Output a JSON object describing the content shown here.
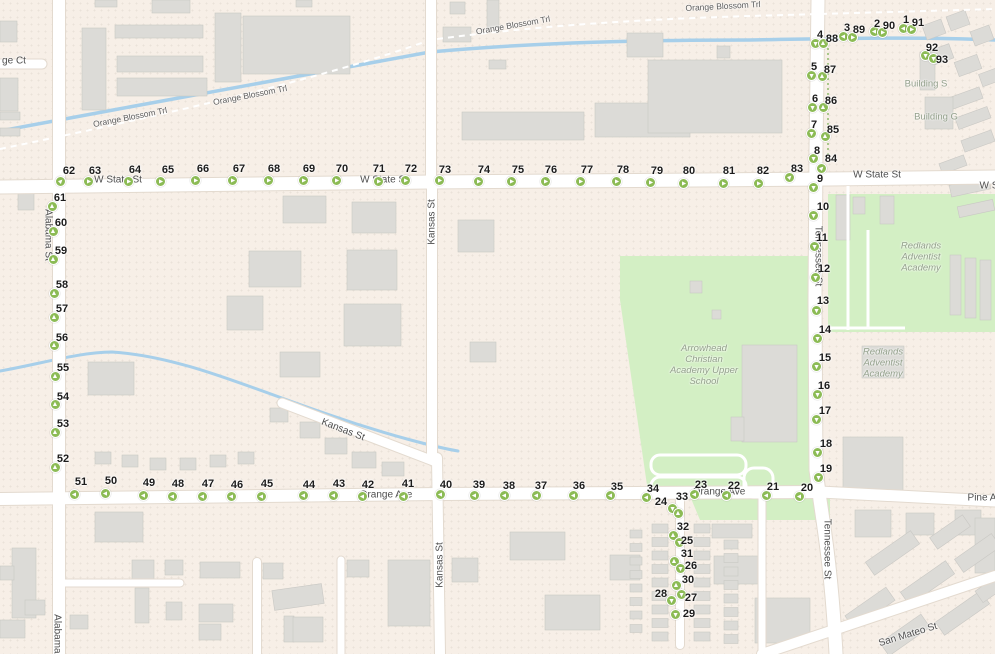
{
  "app": {
    "title": "Map with numbered survey route markers"
  },
  "colors": {
    "land": "#f7efe7",
    "road": "#ffffff",
    "road_casing": "#e3dacf",
    "green_area": "#d3efc4",
    "building": "#dcdbd7",
    "building_edge": "#c9c8c4",
    "water": "#a7cfea",
    "marker_green": "#8cbb55",
    "hedge_green": "#a8c88a"
  },
  "street_labels": [
    {
      "text": "Orange Blossom Trl",
      "x": 130,
      "y": 117,
      "rot": -11,
      "kind": "trail"
    },
    {
      "text": "Orange Blossom Trl",
      "x": 250,
      "y": 95,
      "rot": -11,
      "kind": "trail"
    },
    {
      "text": "Orange Blossom Trl",
      "x": 513,
      "y": 25,
      "rot": -10,
      "kind": "trail"
    },
    {
      "text": "Orange Blossom Trl",
      "x": 723,
      "y": 6,
      "rot": -3,
      "kind": "trail"
    },
    {
      "text": "ge Ct",
      "x": 14,
      "y": 61,
      "rot": 0
    },
    {
      "text": "W State St",
      "x": 118,
      "y": 180,
      "rot": 0
    },
    {
      "text": "W State St",
      "x": 384,
      "y": 180,
      "rot": 0
    },
    {
      "text": "W State St",
      "x": 877,
      "y": 175,
      "rot": 0
    },
    {
      "text": "W S",
      "x": 989,
      "y": 186,
      "rot": 0
    },
    {
      "text": "Orange Ave",
      "x": 386,
      "y": 495,
      "rot": 0
    },
    {
      "text": "Orange Ave",
      "x": 719,
      "y": 492,
      "rot": 0
    },
    {
      "text": "Pine A",
      "x": 982,
      "y": 498,
      "rot": 0
    },
    {
      "text": "Alabama St",
      "x": 48,
      "y": 235,
      "rot": 90
    },
    {
      "text": "Alabama St",
      "x": 57,
      "y": 640,
      "rot": 90
    },
    {
      "text": "Kansas St",
      "x": 432,
      "y": 222,
      "rot": -90
    },
    {
      "text": "Kansas St",
      "x": 440,
      "y": 565,
      "rot": -90
    },
    {
      "text": "Kansas St",
      "x": 343,
      "y": 430,
      "rot": 21
    },
    {
      "text": "Tennessee St",
      "x": 818,
      "y": 256,
      "rot": 90
    },
    {
      "text": "Tennessee St",
      "x": 827,
      "y": 549,
      "rot": 90
    },
    {
      "text": "San Mateo St",
      "x": 908,
      "y": 635,
      "rot": -17
    }
  ],
  "area_labels": [
    {
      "text": "Building S",
      "x": 926,
      "y": 85,
      "italic": false
    },
    {
      "text": "Building G",
      "x": 936,
      "y": 118,
      "italic": false
    },
    {
      "text": "Redlands\nAdventist\nAcademy",
      "x": 921,
      "y": 258,
      "italic": true
    },
    {
      "text": "Redlands\nAdventist\nAcademy",
      "x": 883,
      "y": 364,
      "italic": true
    },
    {
      "text": "Arrowhead\nChristian\nAcademy Upper\nSchool",
      "x": 704,
      "y": 366,
      "italic": true
    }
  ],
  "markers_format": "[number, circle_x, circle_y, arrow_dir(u/d/l/r/ne), label_x, label_y]",
  "markers": [
    [
      1,
      903,
      28,
      "l",
      906,
      20
    ],
    [
      91,
      911,
      29,
      "r",
      918,
      23
    ],
    [
      2,
      874,
      31,
      "l",
      877,
      24
    ],
    [
      90,
      882,
      32,
      "r",
      889,
      26
    ],
    [
      3,
      843,
      36,
      "l",
      847,
      28
    ],
    [
      89,
      852,
      37,
      "r",
      859,
      30
    ],
    [
      4,
      815,
      43,
      "d",
      820,
      35
    ],
    [
      88,
      823,
      43,
      "u",
      832,
      39
    ],
    [
      92,
      925,
      55,
      "d",
      932,
      48
    ],
    [
      93,
      933,
      58,
      "d",
      942,
      60
    ],
    [
      5,
      811,
      75,
      "d",
      814,
      67
    ],
    [
      87,
      822,
      76,
      "u",
      830,
      70
    ],
    [
      6,
      812,
      107,
      "d",
      815,
      99
    ],
    [
      86,
      823,
      107,
      "u",
      831,
      101
    ],
    [
      7,
      811,
      133,
      "d",
      814,
      125
    ],
    [
      85,
      825,
      136,
      "u",
      833,
      130
    ],
    [
      8,
      813,
      158,
      "d",
      817,
      151
    ],
    [
      84,
      821,
      168,
      "ne",
      831,
      159
    ],
    [
      9,
      813,
      187,
      "d",
      820,
      179
    ],
    [
      10,
      813,
      215,
      "d",
      823,
      207
    ],
    [
      11,
      814,
      246,
      "d",
      822,
      238
    ],
    [
      12,
      815,
      277,
      "d",
      824,
      269
    ],
    [
      13,
      816,
      310,
      "d",
      823,
      301
    ],
    [
      14,
      817,
      338,
      "d",
      825,
      330
    ],
    [
      15,
      816,
      366,
      "d",
      825,
      358
    ],
    [
      16,
      817,
      394,
      "d",
      824,
      386
    ],
    [
      17,
      816,
      419,
      "d",
      825,
      411
    ],
    [
      18,
      817,
      452,
      "d",
      826,
      444
    ],
    [
      19,
      818,
      477,
      "d",
      826,
      469
    ],
    [
      20,
      799,
      496,
      "l",
      807,
      488
    ],
    [
      21,
      766,
      495,
      "l",
      773,
      487
    ],
    [
      22,
      726,
      495,
      "l",
      734,
      486
    ],
    [
      23,
      694,
      494,
      "l",
      701,
      485
    ],
    [
      24,
      672,
      508,
      "d",
      661,
      502
    ],
    [
      33,
      678,
      513,
      "u",
      682,
      497
    ],
    [
      32,
      673,
      535,
      "u",
      683,
      527
    ],
    [
      25,
      679,
      542,
      "d",
      687,
      541
    ],
    [
      31,
      674,
      561,
      "u",
      687,
      554
    ],
    [
      26,
      680,
      568,
      "d",
      691,
      566
    ],
    [
      30,
      676,
      585,
      "u",
      688,
      580
    ],
    [
      27,
      681,
      594,
      "d",
      691,
      598
    ],
    [
      28,
      671,
      600,
      "d",
      661,
      594
    ],
    [
      29,
      675,
      614,
      "d",
      689,
      614
    ],
    [
      34,
      646,
      497,
      "l",
      653,
      489
    ],
    [
      35,
      610,
      495,
      "l",
      617,
      487
    ],
    [
      36,
      573,
      495,
      "l",
      579,
      486
    ],
    [
      37,
      536,
      495,
      "l",
      541,
      486
    ],
    [
      38,
      504,
      495,
      "l",
      509,
      486
    ],
    [
      39,
      474,
      495,
      "l",
      479,
      485
    ],
    [
      40,
      440,
      494,
      "l",
      446,
      485
    ],
    [
      41,
      403,
      496,
      "l",
      408,
      484
    ],
    [
      42,
      362,
      496,
      "l",
      368,
      485
    ],
    [
      43,
      333,
      495,
      "l",
      339,
      484
    ],
    [
      44,
      303,
      495,
      "l",
      309,
      485
    ],
    [
      45,
      261,
      496,
      "l",
      267,
      484
    ],
    [
      46,
      231,
      496,
      "l",
      237,
      485
    ],
    [
      47,
      202,
      496,
      "l",
      208,
      484
    ],
    [
      48,
      172,
      496,
      "l",
      178,
      484
    ],
    [
      49,
      143,
      495,
      "l",
      149,
      483
    ],
    [
      50,
      105,
      493,
      "l",
      111,
      481
    ],
    [
      51,
      74,
      494,
      "l",
      81,
      482
    ],
    [
      52,
      55,
      467,
      "u",
      63,
      459
    ],
    [
      53,
      55,
      432,
      "u",
      63,
      424
    ],
    [
      54,
      55,
      404,
      "u",
      63,
      397
    ],
    [
      55,
      55,
      376,
      "u",
      63,
      368
    ],
    [
      56,
      54,
      345,
      "u",
      62,
      338
    ],
    [
      57,
      54,
      317,
      "u",
      62,
      309
    ],
    [
      58,
      54,
      293,
      "u",
      62,
      285
    ],
    [
      59,
      53,
      259,
      "u",
      61,
      251
    ],
    [
      60,
      53,
      231,
      "u",
      61,
      223
    ],
    [
      61,
      52,
      206,
      "u",
      60,
      198
    ],
    [
      62,
      60,
      181,
      "ne",
      69,
      171
    ],
    [
      63,
      88,
      181,
      "r",
      95,
      171
    ],
    [
      64,
      128,
      181,
      "r",
      135,
      170
    ],
    [
      65,
      160,
      181,
      "r",
      168,
      170
    ],
    [
      66,
      195,
      180,
      "r",
      203,
      169
    ],
    [
      67,
      232,
      180,
      "r",
      239,
      169
    ],
    [
      68,
      268,
      180,
      "r",
      274,
      169
    ],
    [
      69,
      303,
      180,
      "r",
      309,
      169
    ],
    [
      70,
      336,
      180,
      "r",
      342,
      169
    ],
    [
      71,
      378,
      181,
      "r",
      379,
      169
    ],
    [
      72,
      405,
      180,
      "r",
      411,
      169
    ],
    [
      73,
      439,
      180,
      "r",
      445,
      170
    ],
    [
      74,
      478,
      181,
      "r",
      484,
      170
    ],
    [
      75,
      511,
      181,
      "r",
      518,
      170
    ],
    [
      76,
      545,
      181,
      "r",
      551,
      170
    ],
    [
      77,
      580,
      181,
      "r",
      587,
      170
    ],
    [
      78,
      616,
      181,
      "r",
      623,
      170
    ],
    [
      79,
      650,
      182,
      "r",
      657,
      171
    ],
    [
      80,
      683,
      183,
      "r",
      689,
      171
    ],
    [
      81,
      723,
      183,
      "r",
      729,
      171
    ],
    [
      82,
      758,
      183,
      "r",
      763,
      171
    ],
    [
      83,
      789,
      177,
      "ne",
      797,
      169
    ]
  ]
}
